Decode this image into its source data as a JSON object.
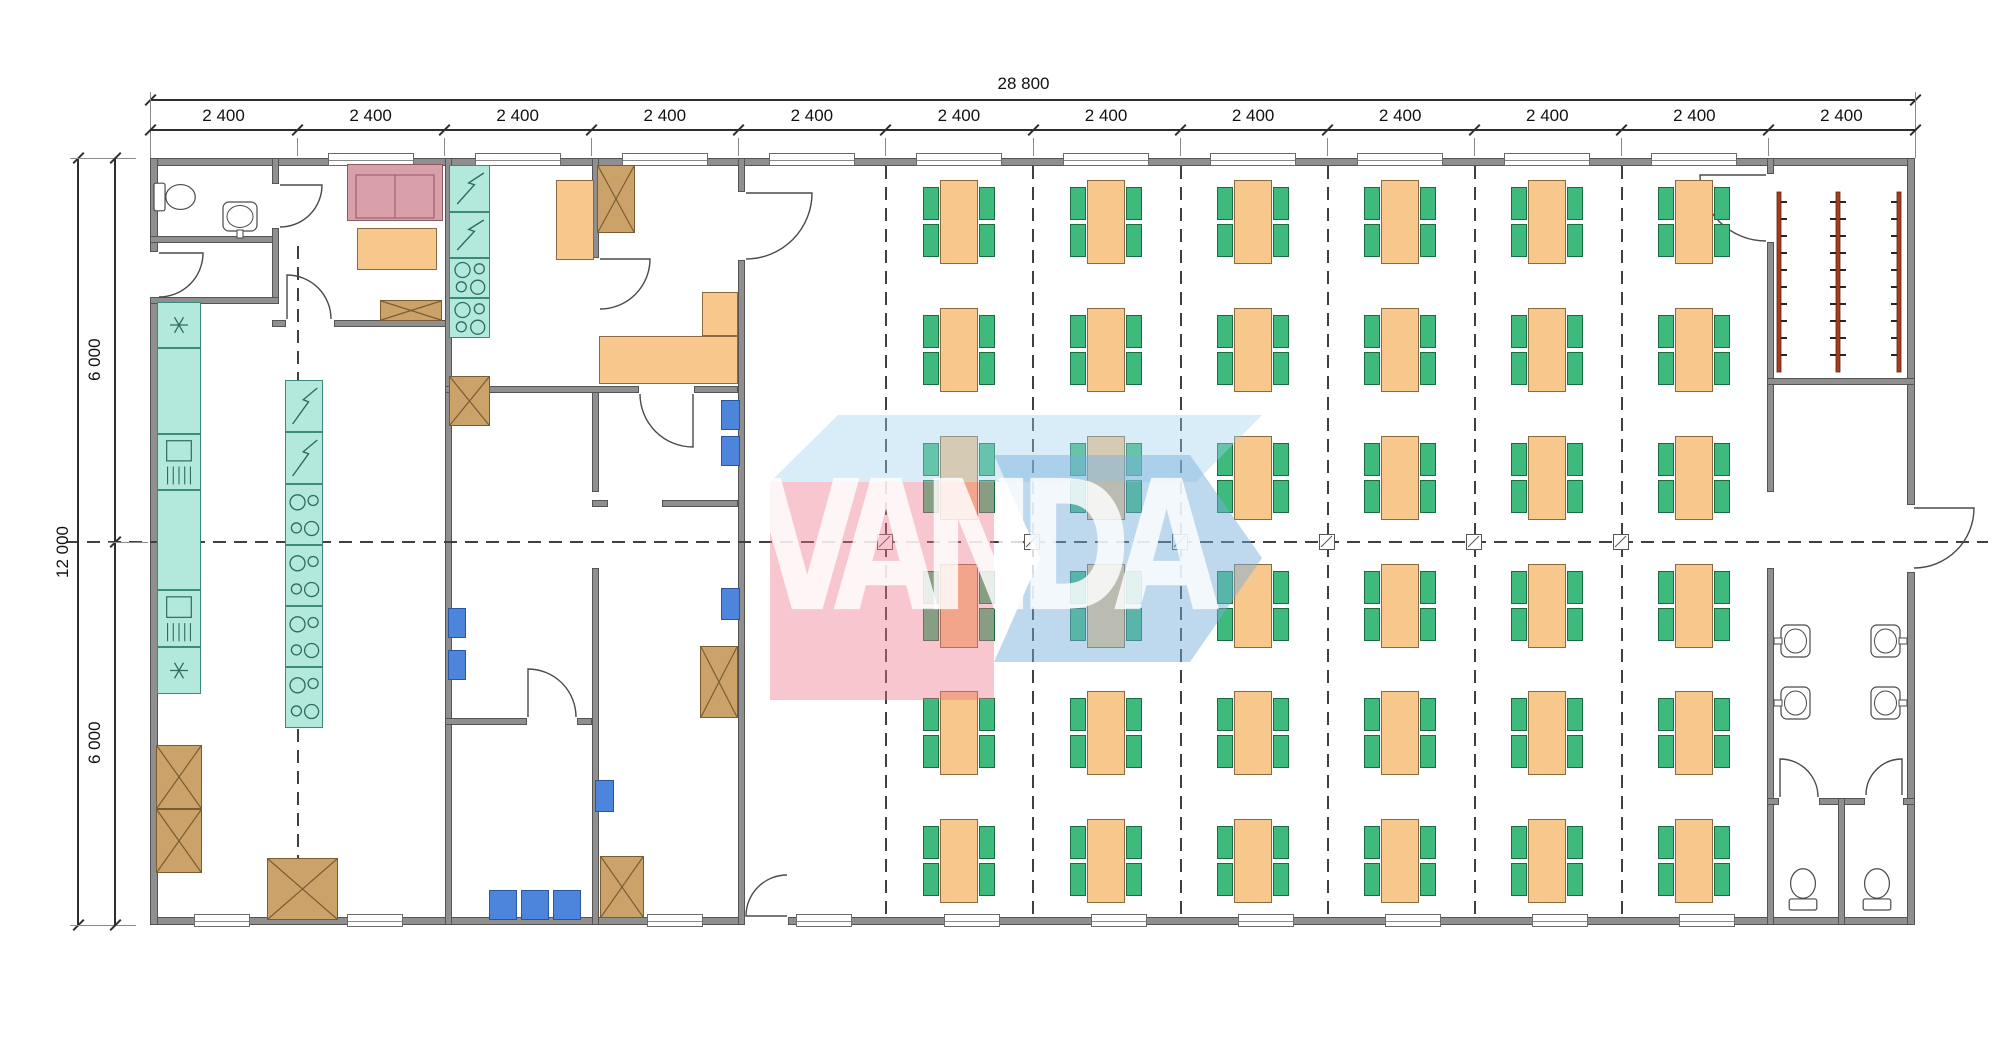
{
  "watermark": {
    "text": "VANDA"
  },
  "dimensions": {
    "total_width_label": "28 800",
    "module_labels": [
      "2 400",
      "2 400",
      "2 400",
      "2 400",
      "2 400",
      "2 400",
      "2 400",
      "2 400",
      "2 400",
      "2 400",
      "2 400",
      "2 400"
    ],
    "total_height_label": "12 000",
    "height_segment_labels": [
      "6 000",
      "6 000"
    ]
  },
  "colors": {
    "wall": "#8f8f8f",
    "wall_edge": "#545454",
    "table": "#f8c78c",
    "table_edge": "#8a6a40",
    "chair": "#3ebb7c",
    "chair_edge": "#1a6b42",
    "teal": "#b2e9dc",
    "teal_edge": "#3d8a7a",
    "crate": "#cba36a",
    "crate_edge": "#7a5c34",
    "blue_chair": "#4d85dd",
    "sofa": "#d9a0aa",
    "sofa_edge": "#8d5a64",
    "coat_rack": "#a63e1e",
    "watermark_pink": "rgba(236,120,140,0.42)",
    "watermark_blue": "rgba(120,175,220,0.48)",
    "watermark_top": "rgba(160,210,240,0.40)"
  },
  "plan": {
    "building": {
      "x": 150,
      "y": 158,
      "w": 1765,
      "h": 767
    },
    "module_count": 12,
    "dining": {
      "rows": 6,
      "cols": 6,
      "col_xs": [
        959,
        1106,
        1253,
        1400,
        1547,
        1694
      ],
      "row_ys": [
        222,
        350,
        478,
        606,
        733,
        861
      ],
      "table_w": 38,
      "table_h": 84,
      "chair_w": 16,
      "chair_h": 33
    },
    "walls": [
      [
        150,
        158,
        1765,
        8
      ],
      [
        150,
        917,
        595,
        8
      ],
      [
        788,
        917,
        1127,
        8
      ],
      [
        150,
        158,
        8,
        94
      ],
      [
        150,
        300,
        8,
        625
      ],
      [
        1907,
        158,
        8,
        347
      ],
      [
        1907,
        572,
        8,
        353
      ],
      [
        150,
        236,
        129,
        7
      ],
      [
        272,
        158,
        7,
        26
      ],
      [
        272,
        228,
        7,
        76
      ],
      [
        150,
        297,
        129,
        7
      ],
      [
        272,
        320,
        14,
        7
      ],
      [
        334,
        320,
        118,
        7
      ],
      [
        445,
        158,
        7,
        767
      ],
      [
        592,
        158,
        7,
        100
      ],
      [
        592,
        386,
        7,
        106
      ],
      [
        592,
        568,
        7,
        357
      ],
      [
        445,
        386,
        194,
        7
      ],
      [
        694,
        386,
        44,
        7
      ],
      [
        592,
        500,
        16,
        7
      ],
      [
        662,
        500,
        76,
        7
      ],
      [
        445,
        718,
        82,
        7
      ],
      [
        577,
        718,
        15,
        7
      ],
      [
        738,
        158,
        7,
        34
      ],
      [
        738,
        260,
        7,
        665
      ],
      [
        1767,
        158,
        7,
        16
      ],
      [
        1767,
        242,
        7,
        250
      ],
      [
        1767,
        568,
        7,
        357
      ],
      [
        1767,
        378,
        148,
        7
      ],
      [
        1767,
        798,
        12,
        7
      ],
      [
        1819,
        798,
        46,
        7
      ],
      [
        1903,
        798,
        12,
        7
      ],
      [
        1838,
        798,
        7,
        127
      ]
    ],
    "windows_top": {
      "y": 153,
      "w": 86,
      "h": 13,
      "xs": [
        328,
        475,
        622,
        769,
        916,
        1063,
        1210,
        1357,
        1504,
        1651
      ]
    },
    "windows_bottom": {
      "y": 914,
      "w": 56,
      "h": 13,
      "xs": [
        194,
        347,
        647,
        796,
        944,
        1091,
        1238,
        1385,
        1532,
        1679
      ]
    },
    "dash_v": [
      [
        297,
        246,
        915
      ],
      [
        885,
        166,
        915
      ],
      [
        1032,
        166,
        915
      ],
      [
        1180,
        166,
        915
      ],
      [
        1327,
        166,
        915
      ],
      [
        1474,
        166,
        915
      ],
      [
        1621,
        166,
        915
      ]
    ],
    "axis": {
      "y": 541,
      "x1": 66,
      "x2": 1988
    },
    "markers_x": [
      885,
      1032,
      1180,
      1327,
      1474,
      1621
    ],
    "doors": [
      {
        "x": 158,
        "y": 252,
        "s": 46,
        "r": 90,
        "fx": 0
      },
      {
        "x": 279,
        "y": 184,
        "s": 44,
        "r": 90,
        "fx": 0
      },
      {
        "x": 286,
        "y": 274,
        "s": 46,
        "r": 0,
        "fx": 0
      },
      {
        "x": 599,
        "y": 258,
        "s": 52,
        "r": 90,
        "fx": 0
      },
      {
        "x": 639,
        "y": 393,
        "s": 55,
        "r": 180,
        "fx": 0
      },
      {
        "x": 527,
        "y": 668,
        "s": 50,
        "r": 0,
        "fx": 0
      },
      {
        "x": 745,
        "y": 874,
        "s": 43,
        "r": 270,
        "fx": 0
      },
      {
        "x": 745,
        "y": 192,
        "s": 68,
        "r": 90,
        "fx": 0
      },
      {
        "x": 1699,
        "y": 174,
        "s": 68,
        "r": 90,
        "fx": 1
      },
      {
        "x": 1913,
        "y": 507,
        "s": 62,
        "r": 90,
        "fx": 0
      },
      {
        "x": 1779,
        "y": 758,
        "s": 40,
        "r": 0,
        "fx": 0
      },
      {
        "x": 1865,
        "y": 758,
        "s": 38,
        "r": 0,
        "fx": 1
      }
    ],
    "items": [
      {
        "t": "toilet",
        "x": 152,
        "y": 174,
        "w": 46,
        "h": 46,
        "r": 0
      },
      {
        "t": "sink",
        "x": 220,
        "y": 200,
        "w": 40,
        "h": 38,
        "r": 180
      },
      {
        "t": "sofa",
        "x": 347,
        "y": 164,
        "w": 96,
        "h": 57
      },
      {
        "t": "otable",
        "x": 357,
        "y": 228,
        "w": 80,
        "h": 42
      },
      {
        "t": "crate",
        "x": 380,
        "y": 300,
        "w": 62,
        "h": 21
      },
      {
        "t": "tealcol",
        "x": 157,
        "y": 302,
        "w": 44,
        "cells": [
          "star",
          "plain",
          "dw",
          "plain",
          "dw",
          "star"
        ],
        "hs": [
          46,
          86,
          56,
          100,
          57,
          47
        ]
      },
      {
        "t": "tealcol",
        "x": 285,
        "y": 380,
        "w": 38,
        "cells": [
          "fr",
          "fr",
          "st",
          "st",
          "st",
          "st"
        ],
        "hs": [
          52,
          52,
          61,
          61,
          61,
          61
        ]
      },
      {
        "t": "tealcol",
        "x": 449,
        "y": 165,
        "w": 41,
        "cells": [
          "fr",
          "fr",
          "st",
          "st"
        ],
        "hs": [
          47,
          46,
          40,
          40
        ]
      },
      {
        "t": "crate",
        "x": 449,
        "y": 376,
        "w": 41,
        "h": 50
      },
      {
        "t": "otable",
        "x": 556,
        "y": 180,
        "w": 38,
        "h": 80
      },
      {
        "t": "crate",
        "x": 597,
        "y": 165,
        "w": 38,
        "h": 68
      },
      {
        "t": "otable",
        "x": 599,
        "y": 336,
        "w": 139,
        "h": 48
      },
      {
        "t": "otable",
        "x": 702,
        "y": 292,
        "w": 36,
        "h": 44
      },
      {
        "t": "crate",
        "x": 156,
        "y": 745,
        "w": 46,
        "h": 64
      },
      {
        "t": "crate",
        "x": 156,
        "y": 809,
        "w": 46,
        "h": 64
      },
      {
        "t": "crate",
        "x": 267,
        "y": 858,
        "w": 71,
        "h": 62
      },
      {
        "t": "bchair",
        "x": 721,
        "y": 400,
        "w": 19,
        "h": 30
      },
      {
        "t": "bchair",
        "x": 721,
        "y": 436,
        "w": 19,
        "h": 30
      },
      {
        "t": "bchair",
        "x": 448,
        "y": 608,
        "w": 18,
        "h": 30
      },
      {
        "t": "bchair",
        "x": 448,
        "y": 650,
        "w": 18,
        "h": 30
      },
      {
        "t": "bchair",
        "x": 721,
        "y": 588,
        "w": 19,
        "h": 32
      },
      {
        "t": "crate",
        "x": 700,
        "y": 646,
        "w": 38,
        "h": 72
      },
      {
        "t": "bchair",
        "x": 595,
        "y": 780,
        "w": 19,
        "h": 32
      },
      {
        "t": "crate",
        "x": 600,
        "y": 856,
        "w": 44,
        "h": 62
      },
      {
        "t": "bchair",
        "x": 489,
        "y": 890,
        "w": 28,
        "h": 30
      },
      {
        "t": "bchair",
        "x": 521,
        "y": 890,
        "w": 28,
        "h": 30
      },
      {
        "t": "bchair",
        "x": 553,
        "y": 890,
        "w": 28,
        "h": 30
      },
      {
        "t": "rack",
        "x": 1779,
        "y": 192,
        "h": 180,
        "side": "right"
      },
      {
        "t": "rack",
        "x": 1838,
        "y": 192,
        "h": 180,
        "side": "both"
      },
      {
        "t": "rack",
        "x": 1899,
        "y": 192,
        "h": 180,
        "side": "left"
      },
      {
        "t": "sink",
        "x": 1774,
        "y": 622,
        "w": 38,
        "h": 38,
        "r": -90
      },
      {
        "t": "sink",
        "x": 1774,
        "y": 684,
        "w": 38,
        "h": 38,
        "r": -90
      },
      {
        "t": "sink",
        "x": 1869,
        "y": 622,
        "w": 38,
        "h": 38,
        "r": 90
      },
      {
        "t": "sink",
        "x": 1869,
        "y": 684,
        "w": 38,
        "h": 38,
        "r": 90
      },
      {
        "t": "toilet",
        "x": 1780,
        "y": 866,
        "w": 46,
        "h": 46,
        "r": -90
      },
      {
        "t": "toilet",
        "x": 1854,
        "y": 866,
        "w": 46,
        "h": 46,
        "r": -90
      }
    ],
    "watermark_shapes": {
      "top_face": "770,482 838,415 1262,415 1196,482",
      "arrow": "994,455 1190,455 1262,558 1190,662 994,662 1040,558",
      "pink": [
        770,
        482,
        224,
        218
      ],
      "text_cx": 978,
      "text_cy": 556
    }
  }
}
